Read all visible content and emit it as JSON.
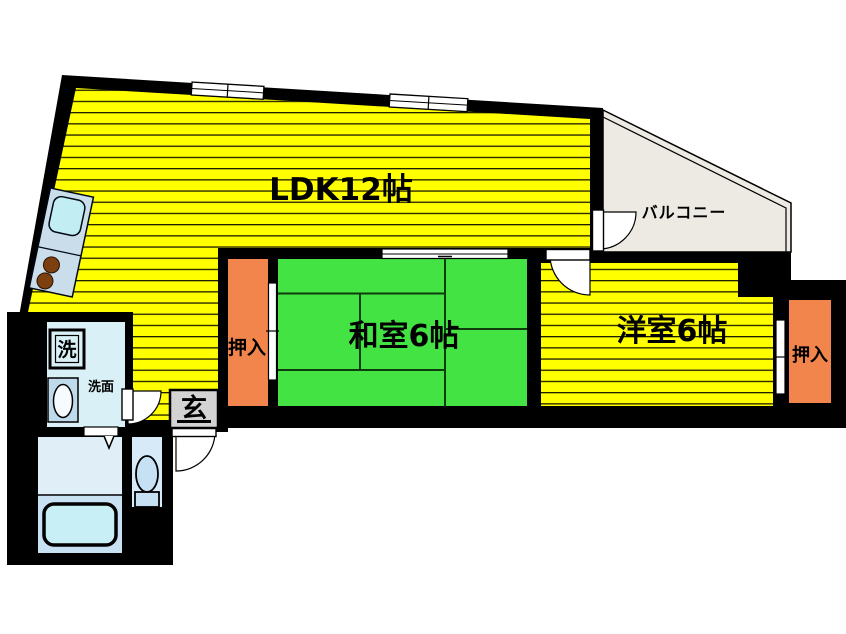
{
  "plan": {
    "labels": {
      "ldk": "LDK12帖",
      "balcony": "バルコニー",
      "japanese_room": "和室6帖",
      "western_room": "洋室6帖",
      "closet_left": "押入",
      "closet_right": "押入",
      "entrance": "玄",
      "washing_machine": "洗",
      "washroom": "洗面"
    },
    "colors": {
      "wall": "#000000",
      "room_yellow": "#FFFF00",
      "stripe_line": "#1C1C00",
      "tatami_green": "#44E344",
      "tatami_line": "#0E3C0E",
      "closet_orange": "#F2854B",
      "balcony_fill": "#EDEAE3",
      "entrance_fill": "#D3D3D3",
      "washroom_fill": "#D9F1F6",
      "bath_upper": "#E0EEF8",
      "bath_lower": "#C9E2F3",
      "tub_fill": "#C9EFF6",
      "toilet_room_fill": "#D7EAF8",
      "fixture_fill": "#C6E0F4",
      "kitchen_counter": "#C9DDEB",
      "kitchen_sink": "#C2EEF3",
      "burner_brown": "#7B3F10",
      "vanity_fill": "#BFDAEB",
      "door_white": "#FFFFFF",
      "text": "#000000"
    }
  }
}
